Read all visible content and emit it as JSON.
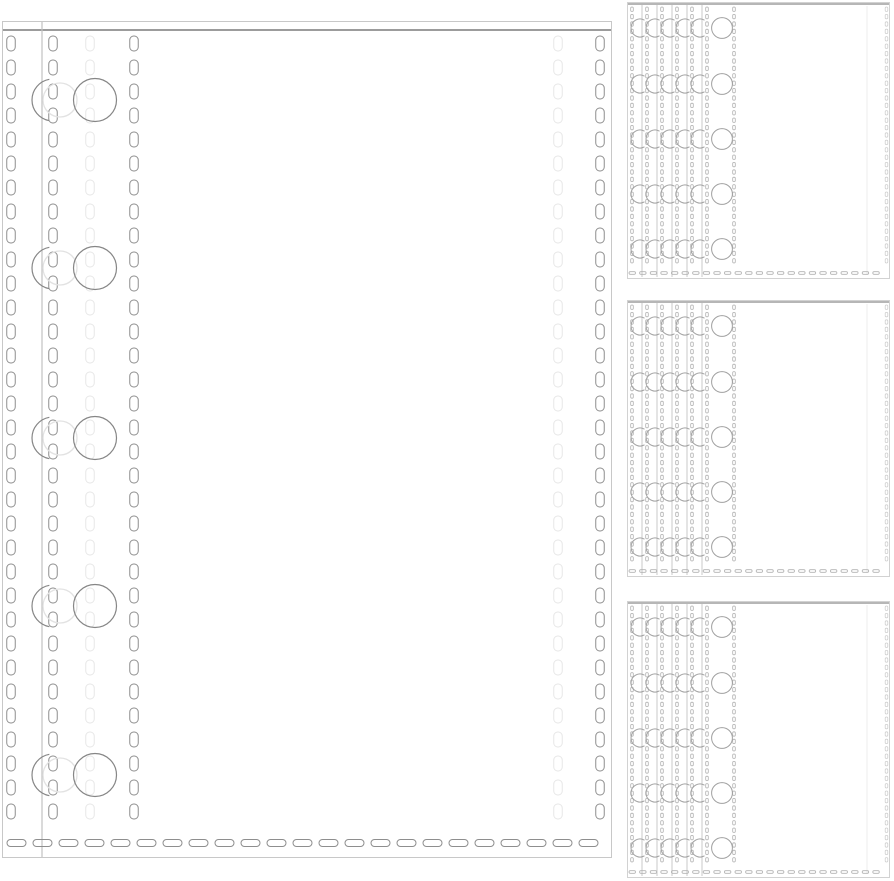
{
  "scene": {
    "type": "product-photo-line-art",
    "subject": "clear plastic binder sheet protectors with stitched seams and punched binder holes",
    "background_color": "#ffffff",
    "large_sheets_shown": 1,
    "stacks_shown": 3,
    "sheets_per_stack": 6,
    "hole_rows_per_sheet": 5
  },
  "palette": {
    "sheet_edge": "#c8c8c8",
    "inner_edge": "#c2c2c2",
    "seam": "#9c9c9c",
    "stitch_dark": "#8e8e8e",
    "stitch_faint": "#e7e7e7",
    "stitch_light": "#b2b2b2",
    "stitch_lighter": "#cfcfcf",
    "hole_dark": "#868686",
    "hole_light": "#a0a0a0",
    "hole_faint": "#e2e2e2",
    "panel_border": "#d2d2d2",
    "panel_seam": "#ababab",
    "faint_line": "#ededed",
    "background": "#ffffff"
  },
  "canvas": {
    "width": 894,
    "height": 881
  },
  "large_sheet": {
    "name": "large-sheet-protector",
    "x": 2,
    "y": 21,
    "width": 610,
    "height": 837,
    "seam_offset": 9,
    "inner_edge_x": 40,
    "stitch_columns": [
      {
        "x": 9,
        "tone": "dark"
      },
      {
        "x": 51,
        "tone": "dark"
      },
      {
        "x": 88,
        "tone": "faint"
      },
      {
        "x": 132,
        "tone": "dark"
      },
      {
        "x": 556,
        "tone": "faint"
      },
      {
        "x": 598,
        "tone": "dark"
      }
    ],
    "hole_rows_y": [
      79,
      247,
      417,
      585,
      754
    ],
    "holes": {
      "full_cx": 93,
      "full_r": 21.5,
      "faint_cx": 58,
      "faint_r": 17,
      "arc_cx": 51,
      "arc_r": 21,
      "arc_start_deg": 100,
      "arc_end_deg": 260
    },
    "v_dash": {
      "w": 8.5,
      "h": 15,
      "rx": 4,
      "period": 24,
      "y0": 15,
      "y1": 820
    },
    "bottom_stitch": {
      "y": 822,
      "x0": 5,
      "x1": 606,
      "w": 19,
      "h": 7,
      "rx": 3.5,
      "period": 26
    }
  },
  "stacks": {
    "name": "sheet-protector-stack",
    "x": 627,
    "width": 263,
    "height": 277,
    "tops_y": [
      2,
      300,
      601
    ],
    "sheet_offset": 15,
    "stitch_dx": 5,
    "extra_stitch_x": 107,
    "right_stitch_x": 259.5,
    "faint_line_x": 240,
    "hole_rows_y": [
      26,
      82,
      137,
      192,
      247
    ],
    "hole": {
      "cx": 95,
      "r": 10.4
    },
    "arc": {
      "dx_from_next_edge": -2,
      "r": 9,
      "start_deg": 60,
      "end_deg": 300
    },
    "v_dash": {
      "w": 2.6,
      "h": 4.4,
      "rx": 1.2,
      "period": 7.4,
      "y0": 5,
      "y1": 268
    },
    "bottom_stitch": {
      "y": 271,
      "x0": 2,
      "x1": 259,
      "w": 6.5,
      "h": 2.6,
      "rx": 1.3,
      "period": 10.6
    }
  }
}
